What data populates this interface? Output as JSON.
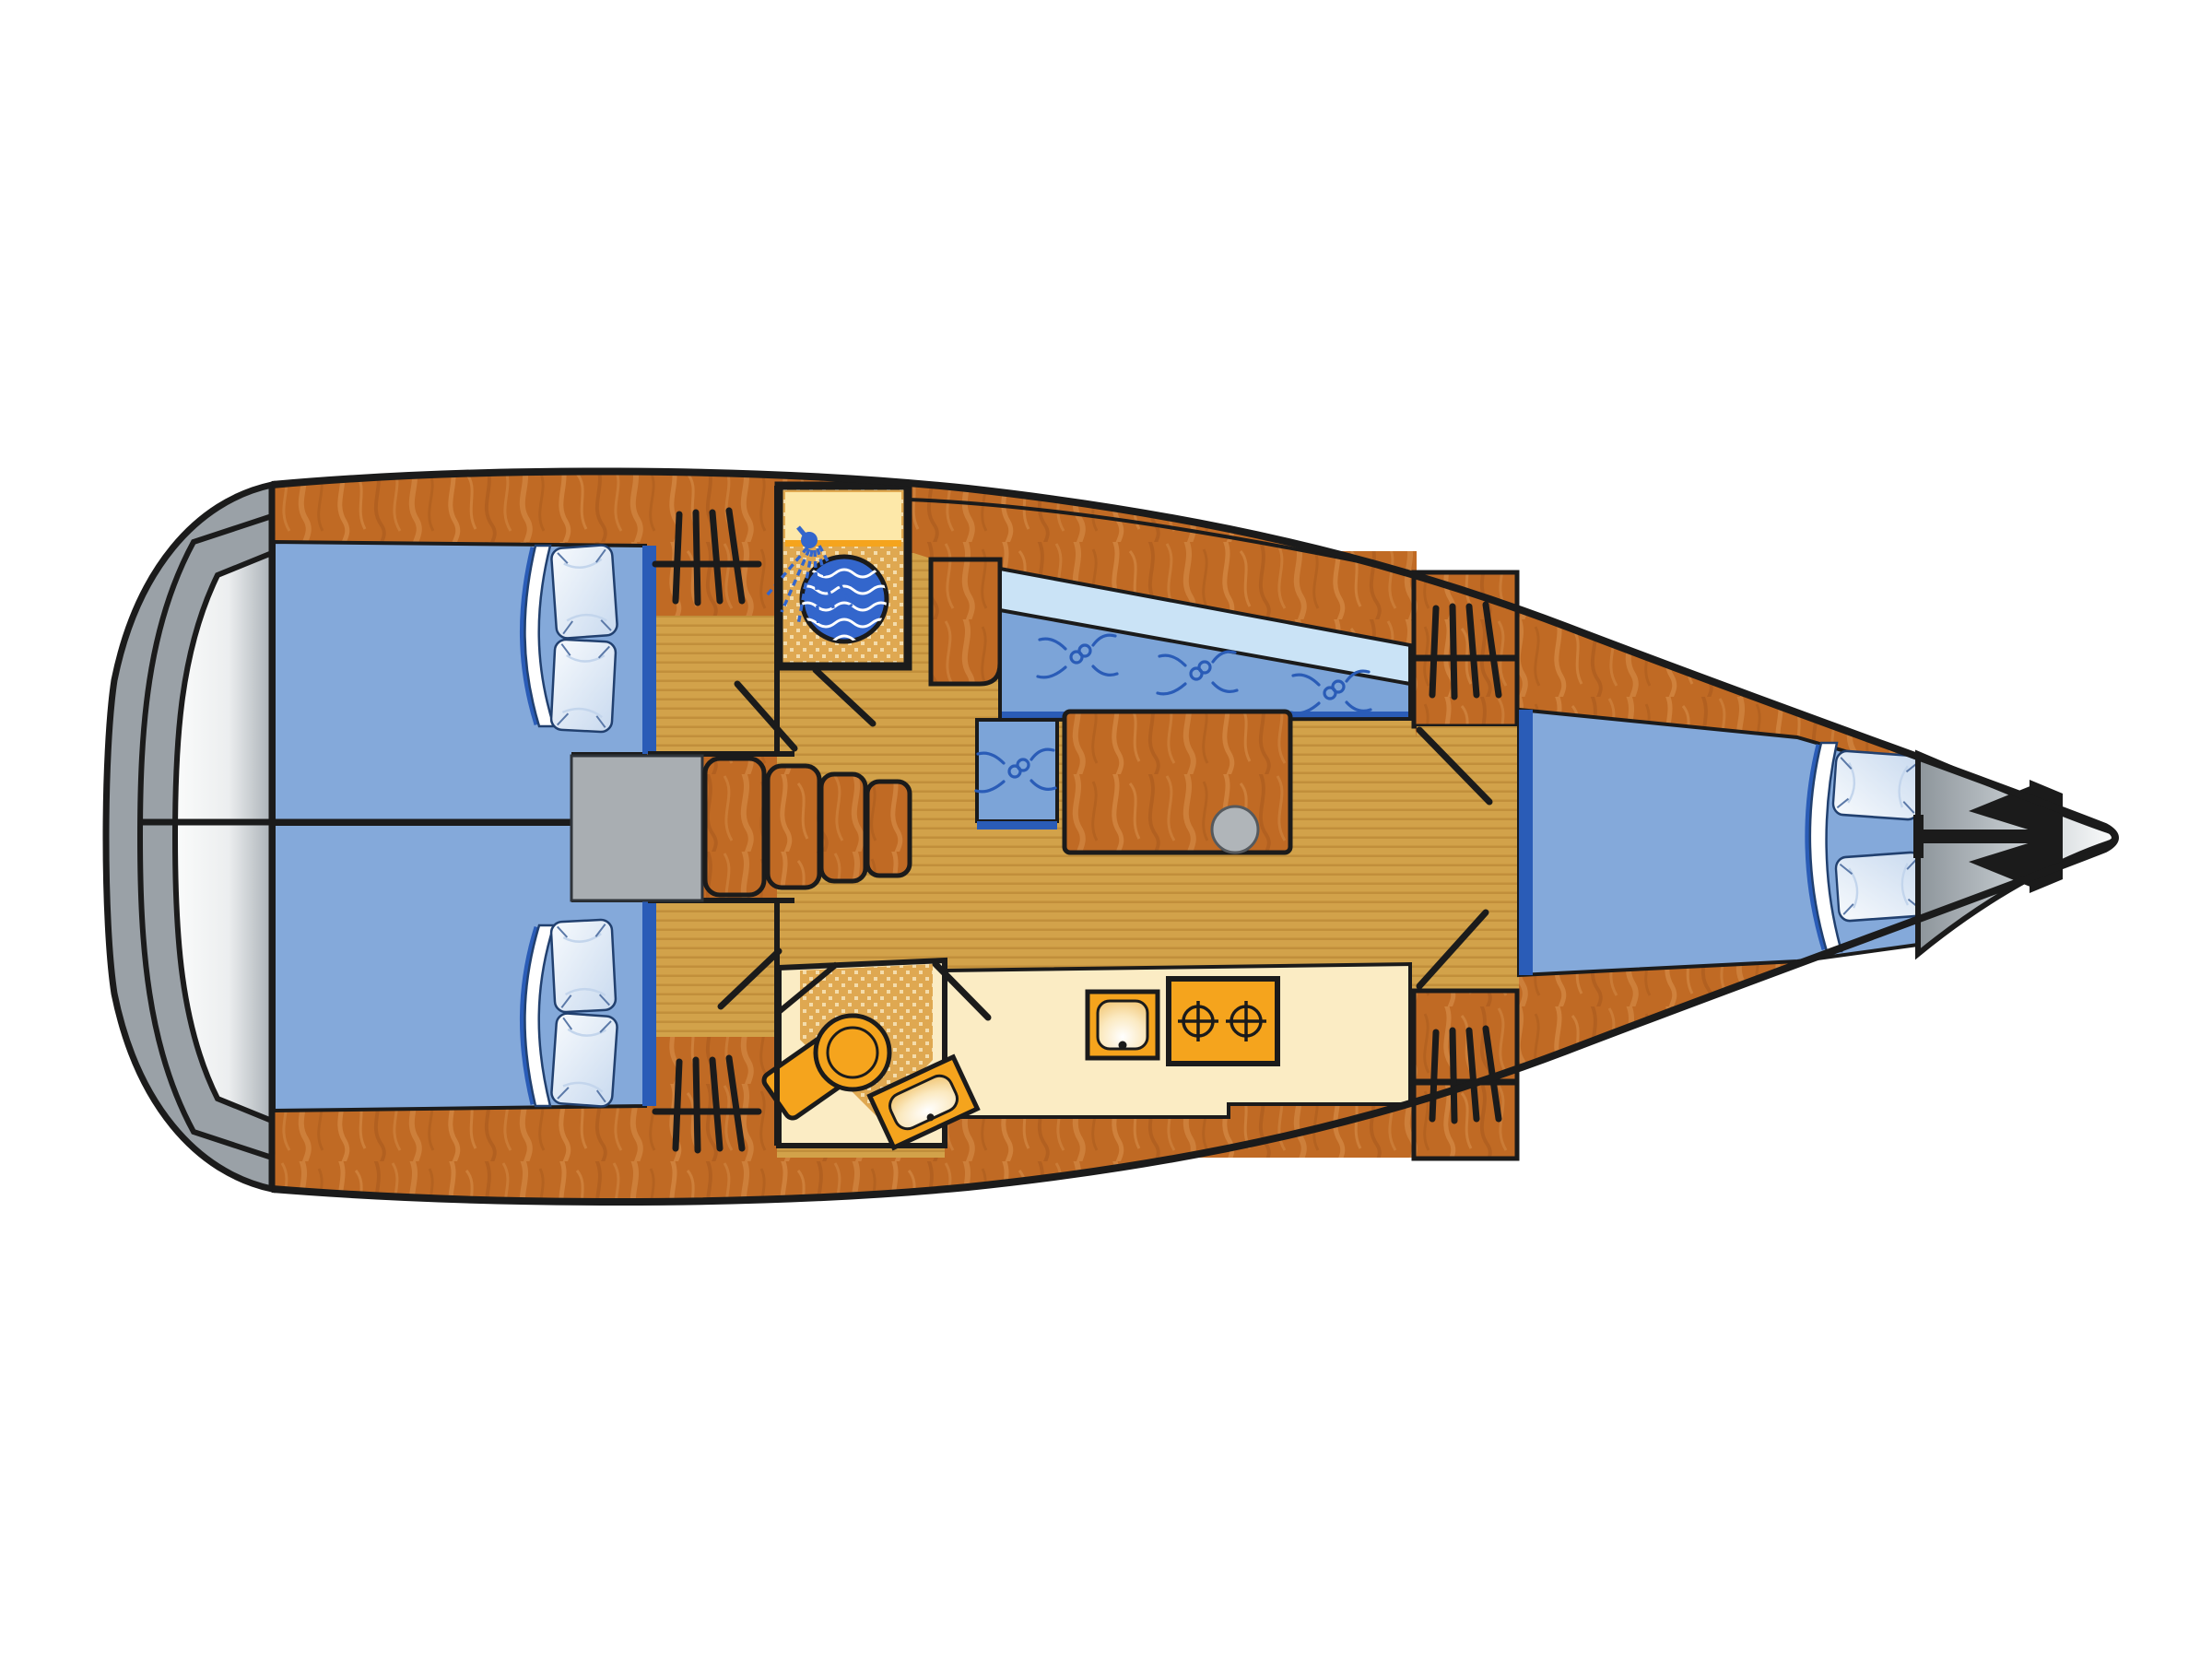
{
  "diagram": {
    "title": "Sailing yacht interior layout plan — top view, bow to the right",
    "type": "boat-floor-plan",
    "orientation": "bow-right"
  },
  "colors": {
    "outline": "#1b1b1b",
    "wood": "#c06a24",
    "woodLight": "#da9350",
    "woodDark": "#a3551a",
    "floor": "#d2a24a",
    "floorLine": "#c18f3b",
    "dotBase": "#dfa851",
    "dotSpot": "#f4dcab",
    "cream": "#fbecc4",
    "creamBand": "#fde8a9",
    "orange": "#f5a41d",
    "bedBlue": "#84a9da",
    "seatBlue": "#7ca4d8",
    "backrestBlue": "#cae3f6",
    "navy": "#2a5cb7",
    "showerBlue": "#3366cc",
    "grayHull": "#9aa1a7",
    "grayLight": "#fafbfb",
    "grayMid": "#b2b9be",
    "grayBox": "#a9aeb2",
    "pedestalGray": "#b0b5b9",
    "pillow": "#eef3fb",
    "pillowShade": "#c3d5ec",
    "white": "#ffffff"
  },
  "rooms": {
    "swim_platform": {
      "label": "Stern swim platform / transom"
    },
    "aft_cabin_port": {
      "label": "Aft cabin (port) with double berth and two pillows"
    },
    "aft_cabin_starboard": {
      "label": "Aft cabin (starboard) with double berth and two pillows"
    },
    "companionway": {
      "label": "Companionway steps and engine box"
    },
    "shower_room": {
      "label": "Shower compartment with shower head and round basin"
    },
    "salon": {
      "label": "Salon with L-settee, backrest, table and pedestal"
    },
    "galley": {
      "label": "Galley with sink and two-burner stove"
    },
    "head": {
      "label": "Head with toilet and wash basin"
    },
    "bow_cabin": {
      "label": "Forward V-berth cabin with two pillows"
    },
    "foredeck": {
      "label": "Foredeck with anchor"
    }
  },
  "features": {
    "pillow_count": 6,
    "settee_buttons": 4,
    "steps": 4,
    "hatches": 4,
    "doors": 7,
    "burners": 2
  }
}
